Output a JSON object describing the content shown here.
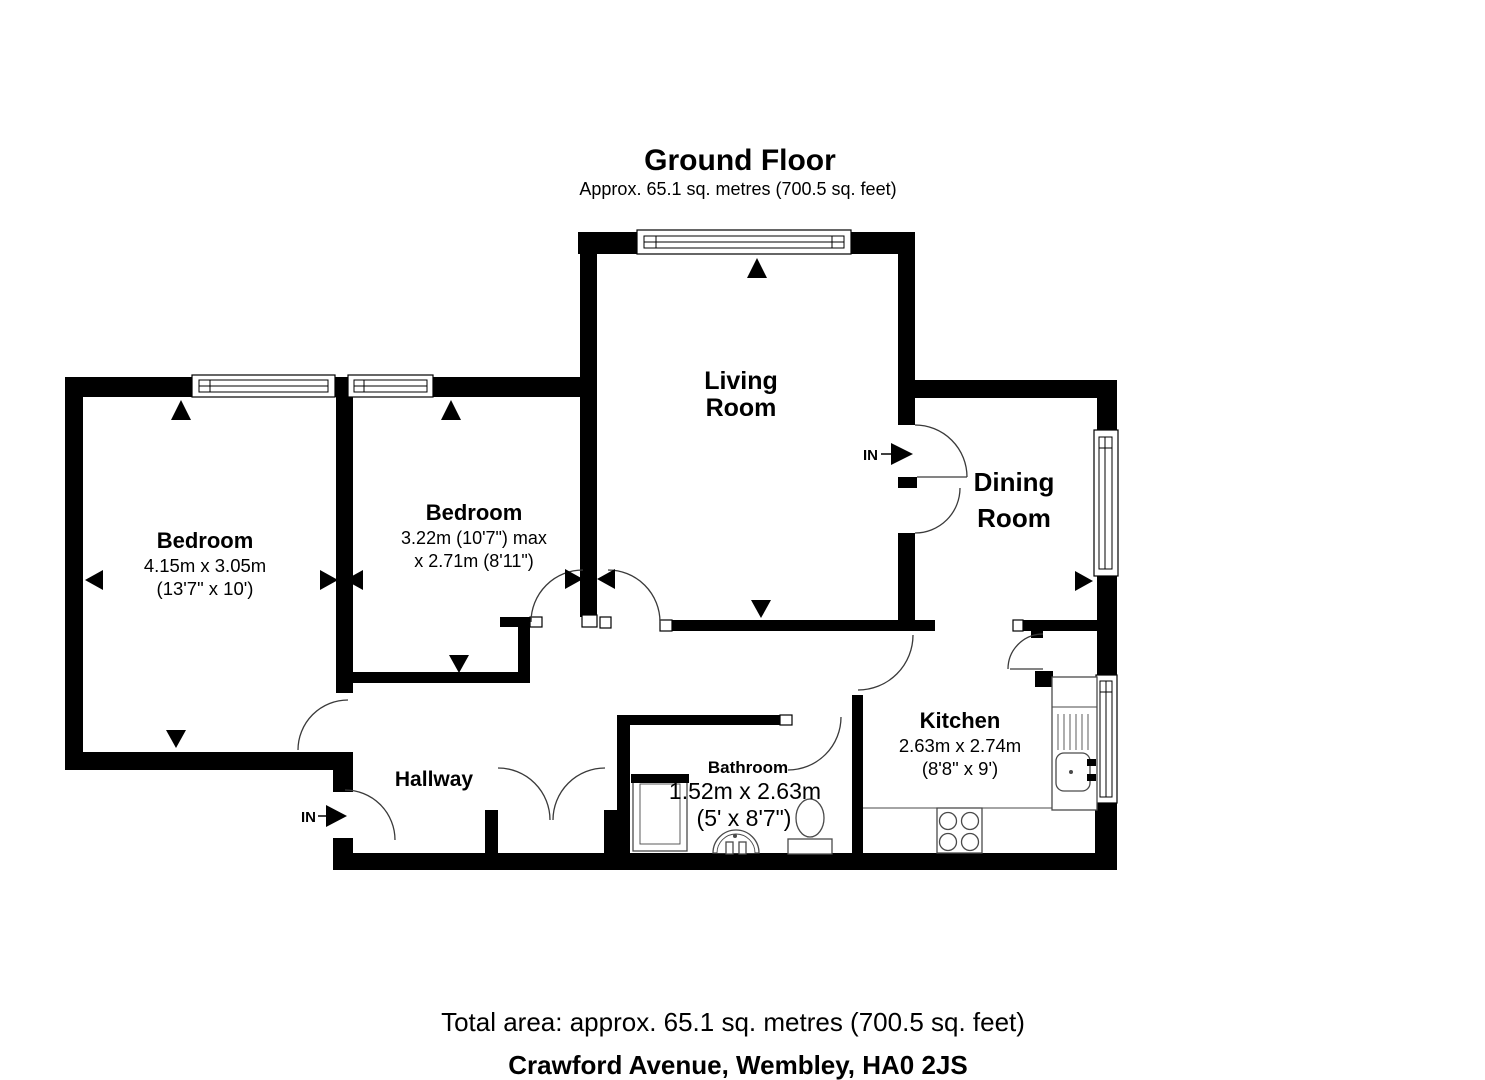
{
  "header": {
    "title": "Ground Floor",
    "subtitle": "Approx. 65.1 sq. metres (700.5 sq. feet)"
  },
  "rooms": {
    "living": {
      "name_line1": "Living",
      "name_line2": "Room"
    },
    "dining": {
      "name_line1": "Dining",
      "name_line2": "Room"
    },
    "bedroom1": {
      "name": "Bedroom",
      "dims_metric": "4.15m x 3.05m",
      "dims_imperial": "(13'7\" x 10')"
    },
    "bedroom2": {
      "name": "Bedroom",
      "dims_line1": "3.22m (10'7\") max",
      "dims_line2": "x 2.71m (8'11\")"
    },
    "hallway": {
      "name": "Hallway"
    },
    "bathroom": {
      "name": "Bathroom",
      "dims_metric": "1.52m x 2.63m",
      "dims_imperial": "(5' x 8'7\")"
    },
    "kitchen": {
      "name": "Kitchen",
      "dims_metric": "2.63m x 2.74m",
      "dims_imperial": "(8'8\" x 9')"
    }
  },
  "entrance": {
    "label_main": "IN",
    "label_hall": "IN"
  },
  "footer": {
    "total_area": "Total area: approx. 65.1 sq. metres (700.5 sq. feet)",
    "address": "Crawford Avenue, Wembley, HA0 2JS"
  },
  "colors": {
    "wall": "#000000",
    "door_arc": "#3a3a3a",
    "fixture": "#4a4a4a",
    "background": "#ffffff"
  }
}
